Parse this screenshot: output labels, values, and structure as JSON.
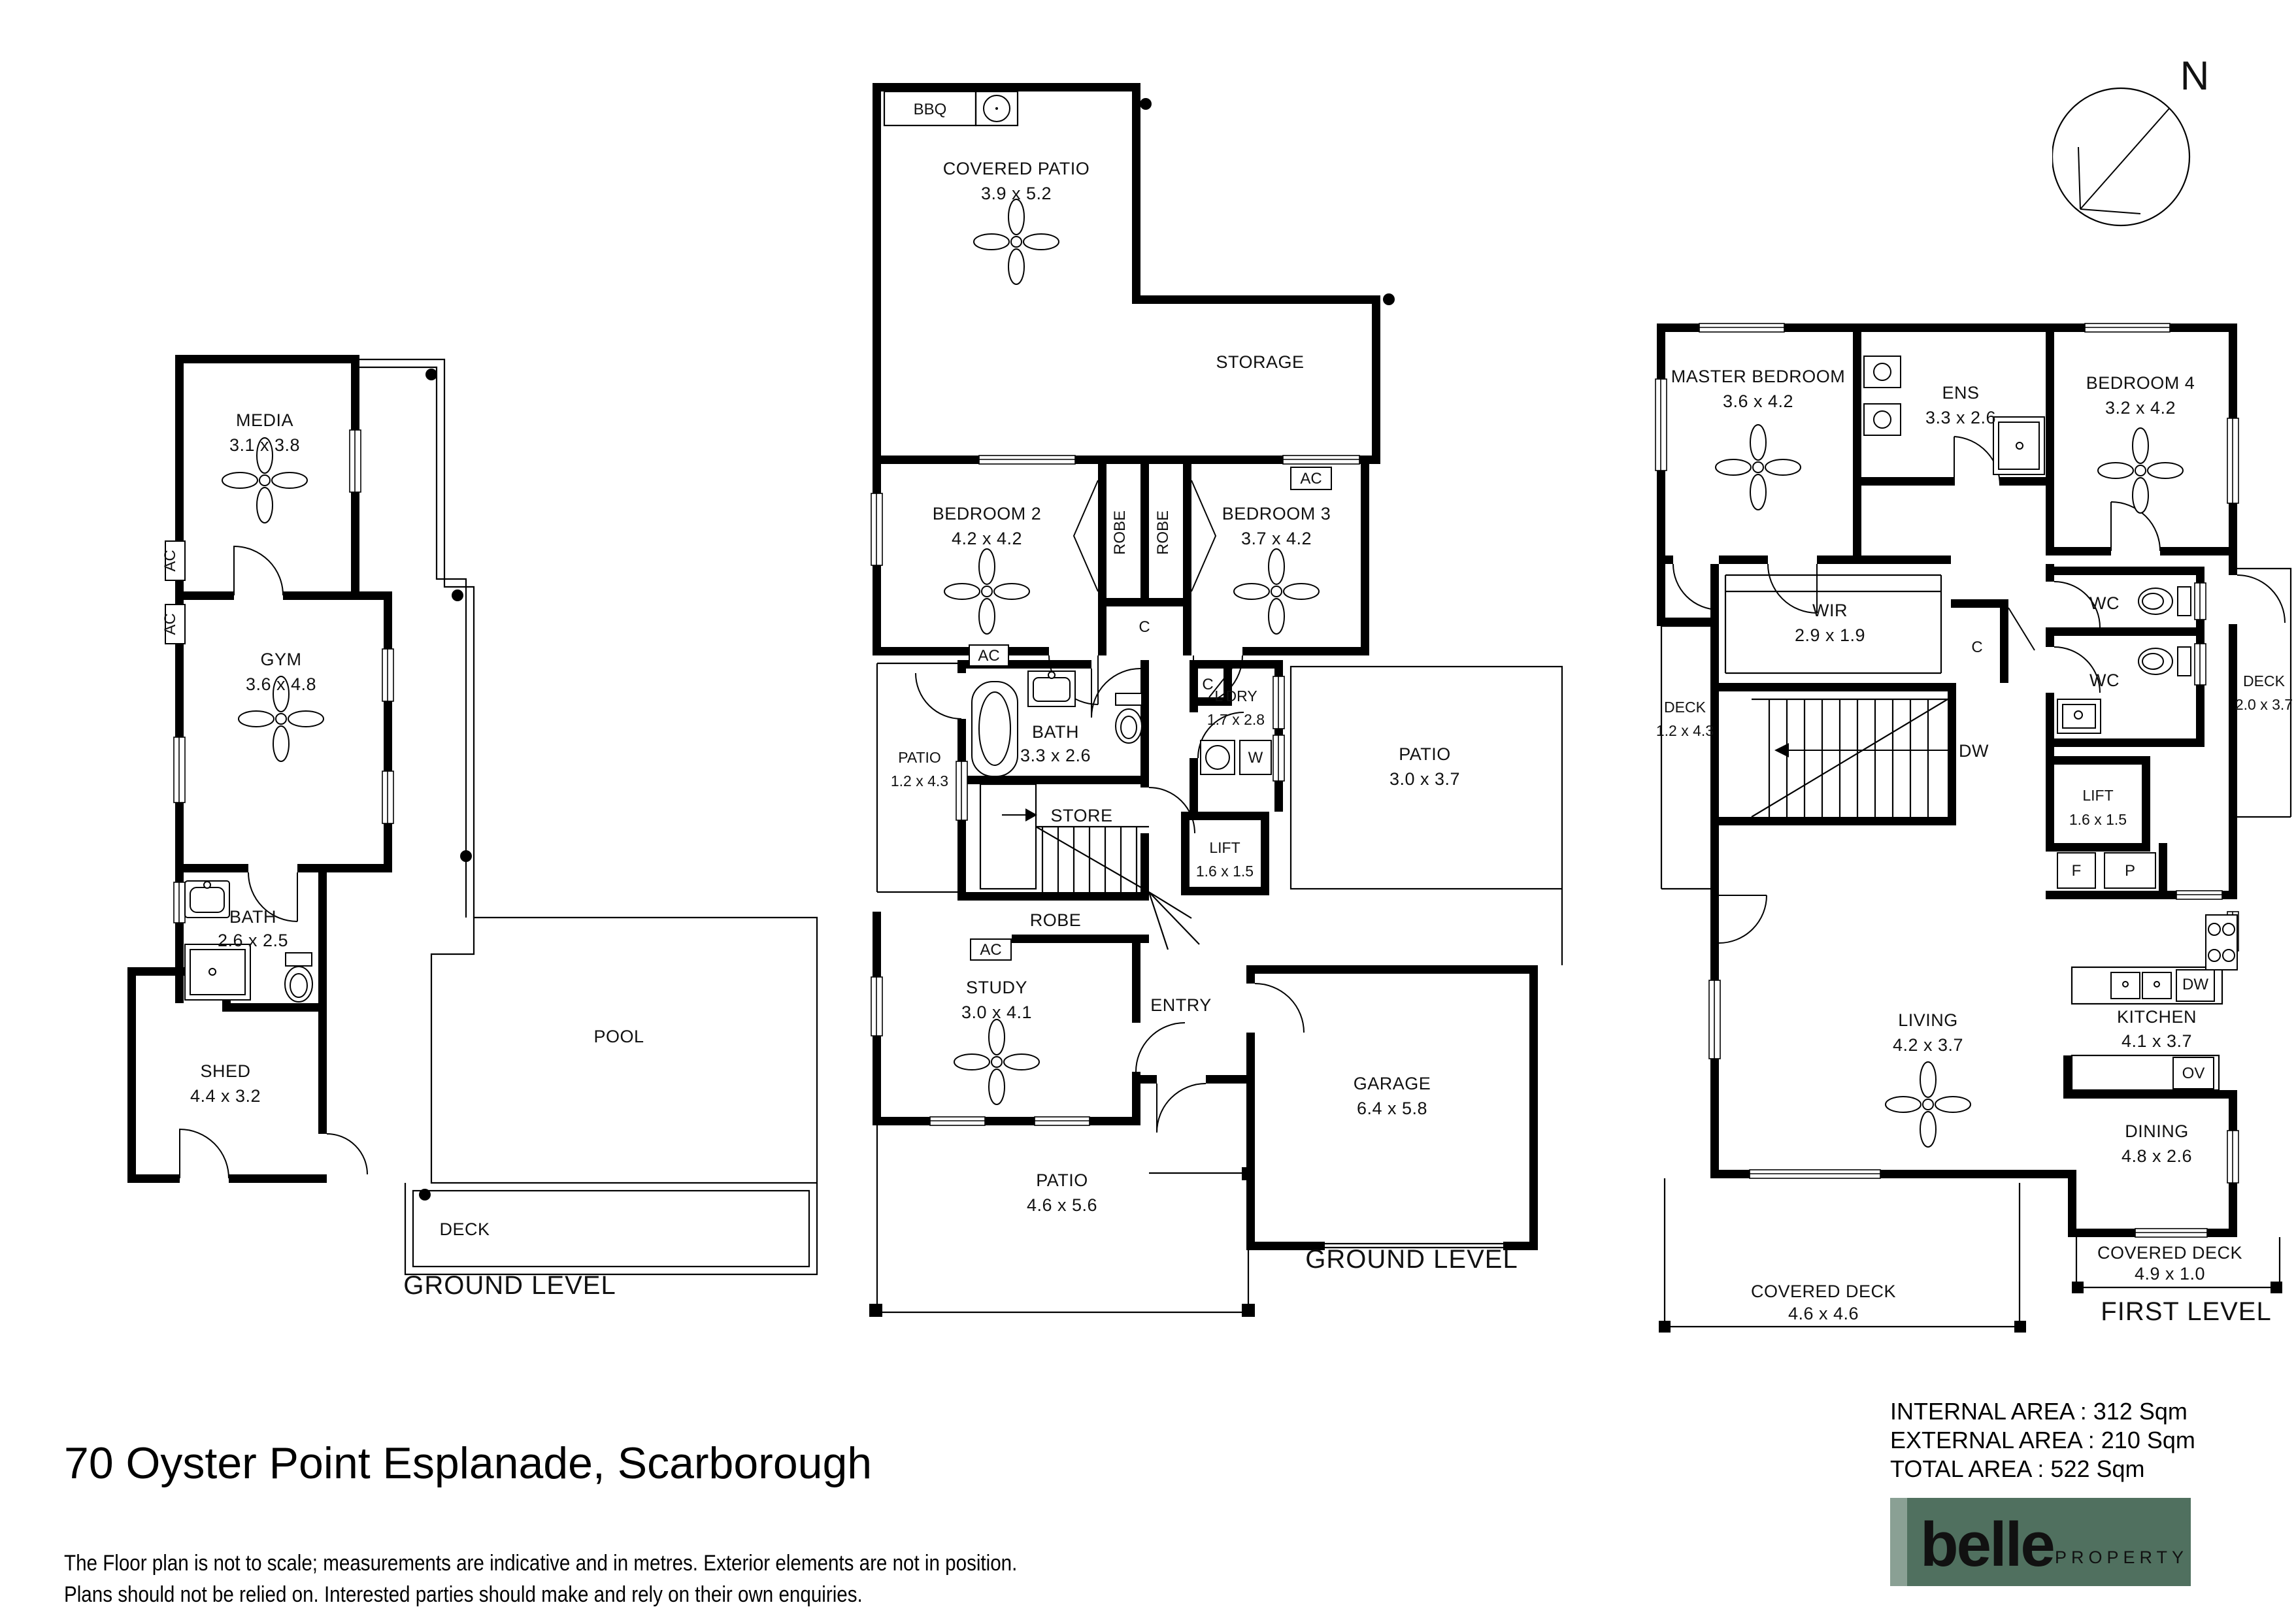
{
  "page": {
    "address": "70 Oyster Point Esplanade, Scarborough",
    "disclaimer_line1": "The Floor plan is not to scale; measurements are indicative and in metres. Exterior elements are not in position.",
    "disclaimer_line2": "Plans should not be relied on. Interested parties should make and rely on their own enquiries.",
    "compass": {
      "north_label": "N"
    }
  },
  "areas": {
    "internal": "INTERNAL AREA : 312 Sqm",
    "external": "EXTERNAL AREA : 210 Sqm",
    "total": "TOTAL AREA : 522 Sqm"
  },
  "logo": {
    "brand": "belle",
    "suffix": "PROPERTY",
    "colors": {
      "bg": "#50705f",
      "accent": "#8aa094",
      "text": "#ffffff"
    }
  },
  "plans": {
    "left": {
      "level_label": "GROUND LEVEL",
      "rooms": {
        "media": {
          "label": "MEDIA",
          "dim": "3.1 x 3.8"
        },
        "gym": {
          "label": "GYM",
          "dim": "3.6 x 4.8"
        },
        "bath": {
          "label": "BATH",
          "dim": "2.6 x 2.5"
        },
        "shed": {
          "label": "SHED",
          "dim": "4.4 x 3.2"
        },
        "pool": {
          "label": "POOL"
        },
        "deck": {
          "label": "DECK"
        }
      },
      "tags": {
        "ac1": "AC",
        "ac2": "AC"
      }
    },
    "middle": {
      "level_label": "GROUND LEVEL",
      "rooms": {
        "bbq": {
          "label": "BBQ"
        },
        "cpatio": {
          "label": "COVERED PATIO",
          "dim": "3.9 x 5.2"
        },
        "storage": {
          "label": "STORAGE"
        },
        "bed2": {
          "label": "BEDROOM 2",
          "dim": "4.2 x 4.2"
        },
        "bed3": {
          "label": "BEDROOM 3",
          "dim": "3.7 x 4.2"
        },
        "robe1": {
          "label": "ROBE"
        },
        "robe2": {
          "label": "ROBE"
        },
        "c1": {
          "label": "C"
        },
        "bath": {
          "label": "BATH",
          "dim": "3.3 x 2.6"
        },
        "patio12": {
          "label": "PATIO",
          "dim": "1.2 x 4.3"
        },
        "c2": {
          "label": "C"
        },
        "ldry": {
          "label": "L'DRY",
          "dim": "1.7 x 2.8"
        },
        "w": {
          "label": "W"
        },
        "store": {
          "label": "STORE"
        },
        "lift": {
          "label": "LIFT",
          "dim": "1.6 x 1.5"
        },
        "patio30": {
          "label": "PATIO",
          "dim": "3.0 x 3.7"
        },
        "robe3": {
          "label": "ROBE"
        },
        "study": {
          "label": "STUDY",
          "dim": "3.0 x 4.1"
        },
        "entry": {
          "label": "ENTRY"
        },
        "garage": {
          "label": "GARAGE",
          "dim": "6.4 x 5.8"
        },
        "patio46": {
          "label": "PATIO",
          "dim": "4.6 x 5.6"
        }
      },
      "tags": {
        "ac_storage": "AC",
        "ac_bath": "AC",
        "ac_robe": "AC"
      }
    },
    "right": {
      "level_label": "FIRST LEVEL",
      "rooms": {
        "master": {
          "label": "MASTER BEDROOM",
          "dim": "3.6 x 4.2"
        },
        "ens": {
          "label": "ENS",
          "dim": "3.3 x 2.6"
        },
        "bed4": {
          "label": "BEDROOM 4",
          "dim": "3.2 x 4.2"
        },
        "wir": {
          "label": "WIR",
          "dim": "2.9 x 1.9"
        },
        "c": {
          "label": "C"
        },
        "wc1": {
          "label": "WC"
        },
        "wc2": {
          "label": "WC"
        },
        "deck12": {
          "label": "DECK",
          "dim": "1.2 x 4.3"
        },
        "deck20": {
          "label": "DECK",
          "dim": "2.0 x 3.7"
        },
        "dw_stair": {
          "label": "DW"
        },
        "lift": {
          "label": "LIFT",
          "dim": "1.6 x 1.5"
        },
        "f": {
          "label": "F"
        },
        "p": {
          "label": "P"
        },
        "living": {
          "label": "LIVING",
          "dim": "4.2 x 3.7"
        },
        "kitchen": {
          "label": "KITCHEN",
          "dim": "4.1 x 3.7"
        },
        "dw": {
          "label": "DW"
        },
        "ov": {
          "label": "OV"
        },
        "dining": {
          "label": "DINING",
          "dim": "4.8 x 2.6"
        },
        "cdeck49": {
          "label": "COVERED DECK",
          "dim": "4.9 x 1.0"
        },
        "cdeck46": {
          "label": "COVERED DECK",
          "dim": "4.6 x 4.6"
        }
      }
    }
  }
}
